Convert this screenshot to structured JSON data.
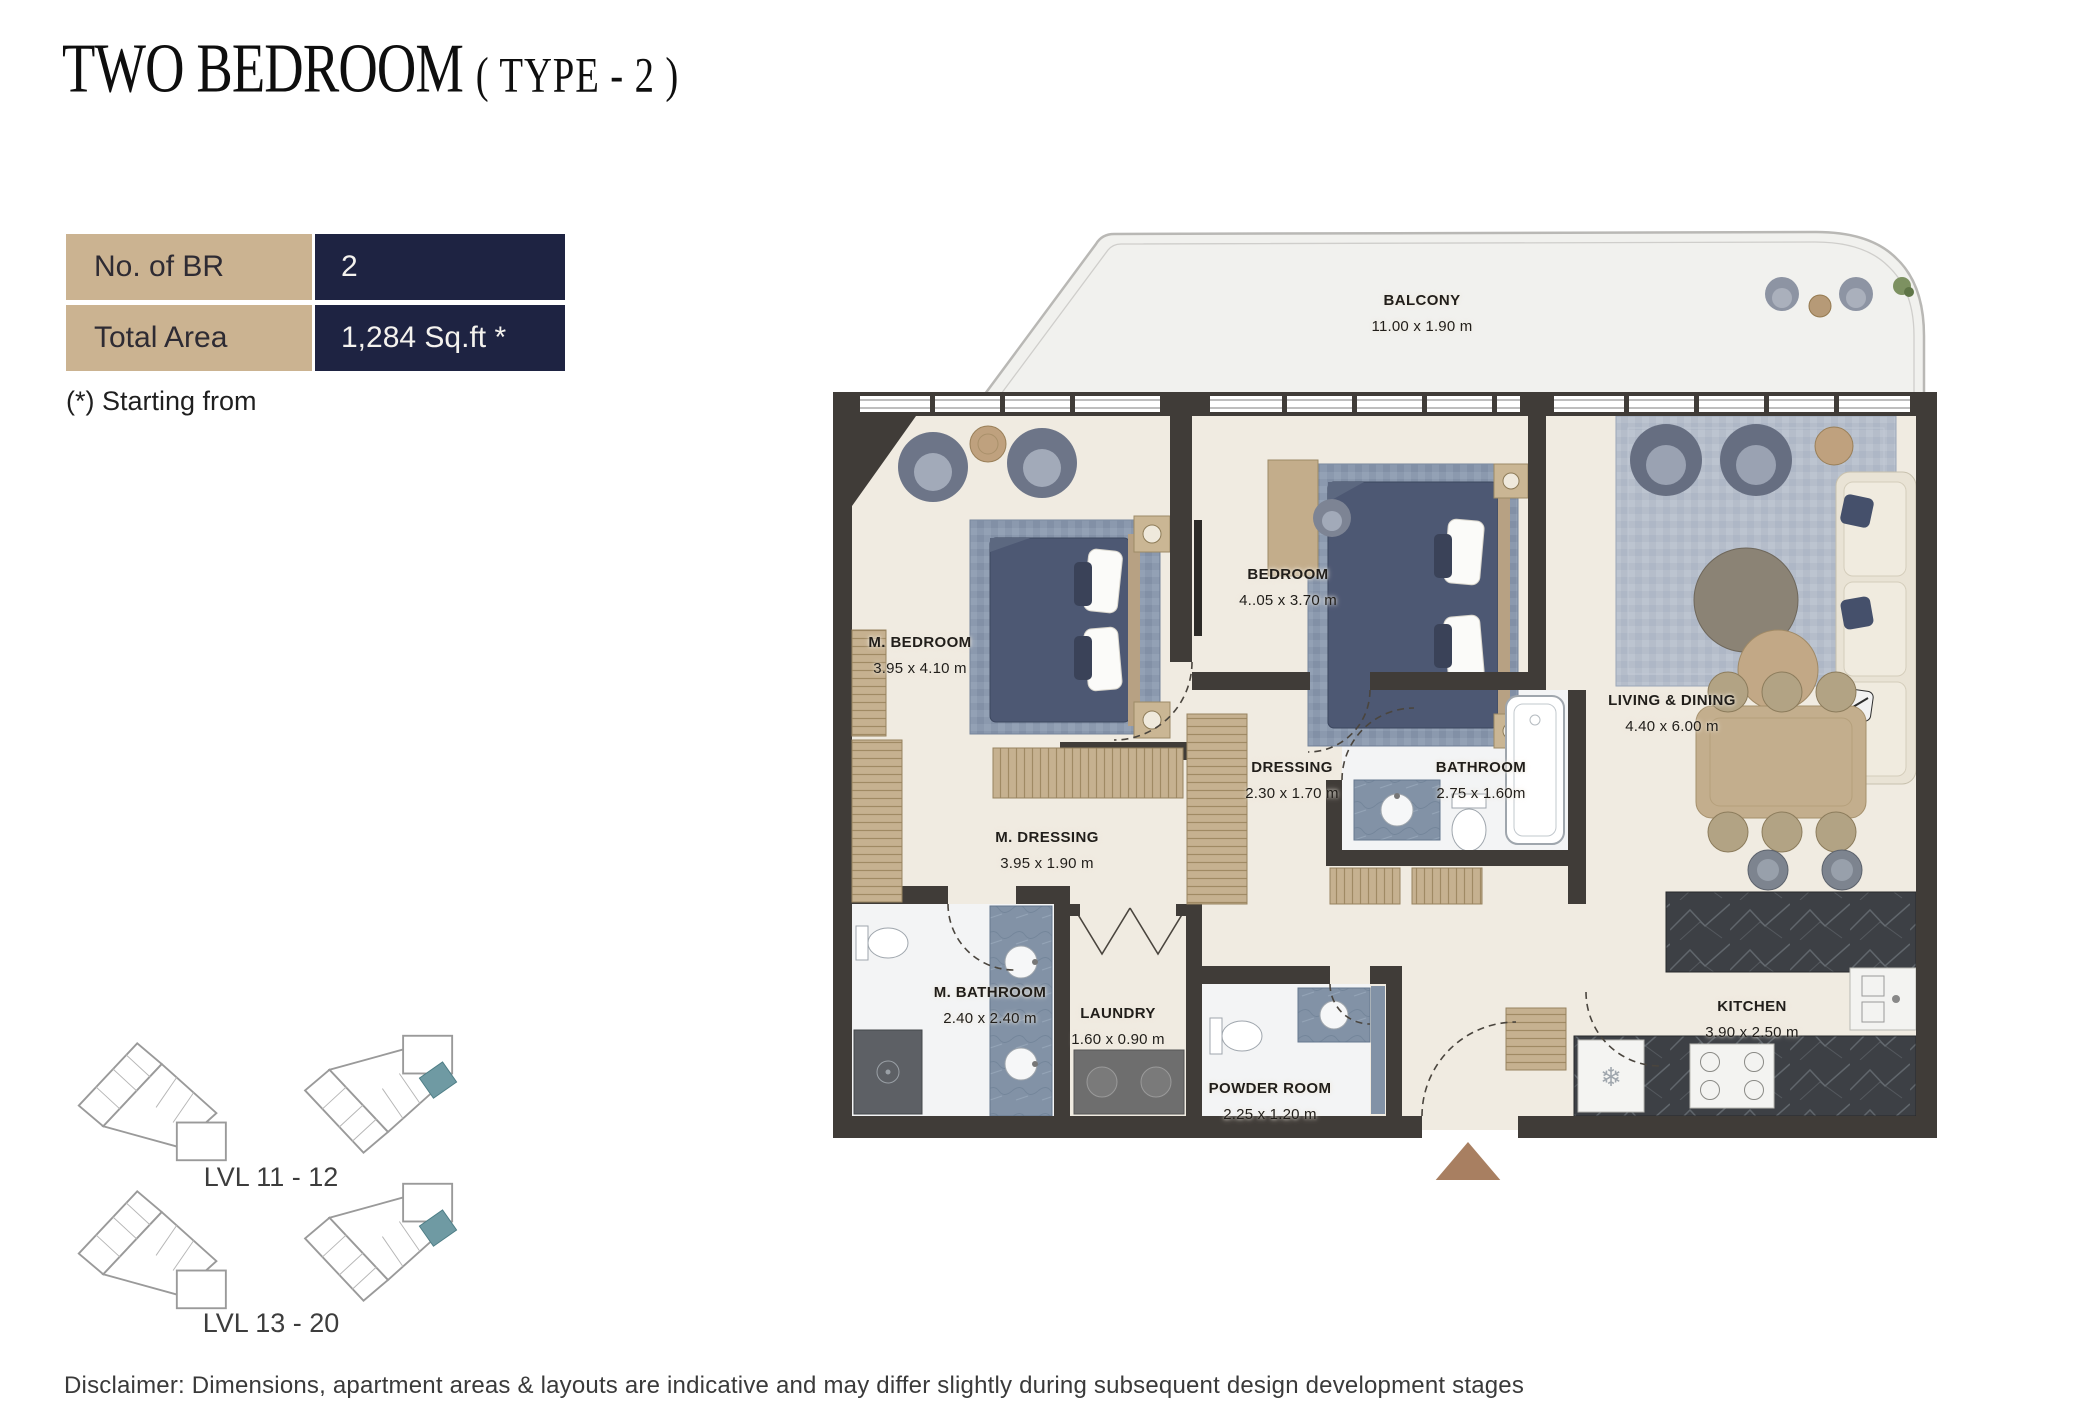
{
  "header": {
    "title_main": "TWO BEDROOM",
    "title_sub": "( TYPE - 2 )"
  },
  "info_table": {
    "rows": [
      {
        "label": "No. of BR",
        "value": "2"
      },
      {
        "label": "Total Area",
        "value": "1,284 Sq.ft *"
      }
    ]
  },
  "note": "(*) Starting from",
  "rooms": [
    {
      "name": "BALCONY",
      "dims": "11.00 x 1.90 m"
    },
    {
      "name": "M. BEDROOM",
      "dims": "3.95 x 4.10 m"
    },
    {
      "name": "BEDROOM",
      "dims": "4..05 x 3.70 m"
    },
    {
      "name": "LIVING & DINING",
      "dims": "4.40 x 6.00 m"
    },
    {
      "name": "DRESSING",
      "dims": "2.30 x 1.70 m"
    },
    {
      "name": "BATHROOM",
      "dims": "2.75 x 1.60m"
    },
    {
      "name": "M. DRESSING",
      "dims": "3.95 x 1.90 m"
    },
    {
      "name": "M. BATHROOM",
      "dims": "2.40 x 2.40 m"
    },
    {
      "name": "LAUNDRY",
      "dims": "1.60 x 0.90 m"
    },
    {
      "name": "POWDER ROOM",
      "dims": "2.25 x 1.20 m"
    },
    {
      "name": "KITCHEN",
      "dims": "3.90 x 2.50 m"
    }
  ],
  "key_plans": [
    {
      "label": "LVL 11 - 12"
    },
    {
      "label": "LVL 13 - 20"
    }
  ],
  "disclaimer": "Disclaimer: Dimensions, apartment areas & layouts are indicative and may differ slightly during subsequent design development stages",
  "icons": {
    "snowflake": "❄"
  },
  "colors": {
    "table_label_bg": "#cbb391",
    "table_value_bg": "#1e2342",
    "wall": "#403c38",
    "floor": "#f0ebe1",
    "rug": "#8b99ae",
    "wood": "#c5ae8c",
    "marble": "#3d4045",
    "tile": "#8292a6",
    "entrance_arrow": "#a87f61",
    "keyplan_highlight": "#6f9aa3"
  }
}
